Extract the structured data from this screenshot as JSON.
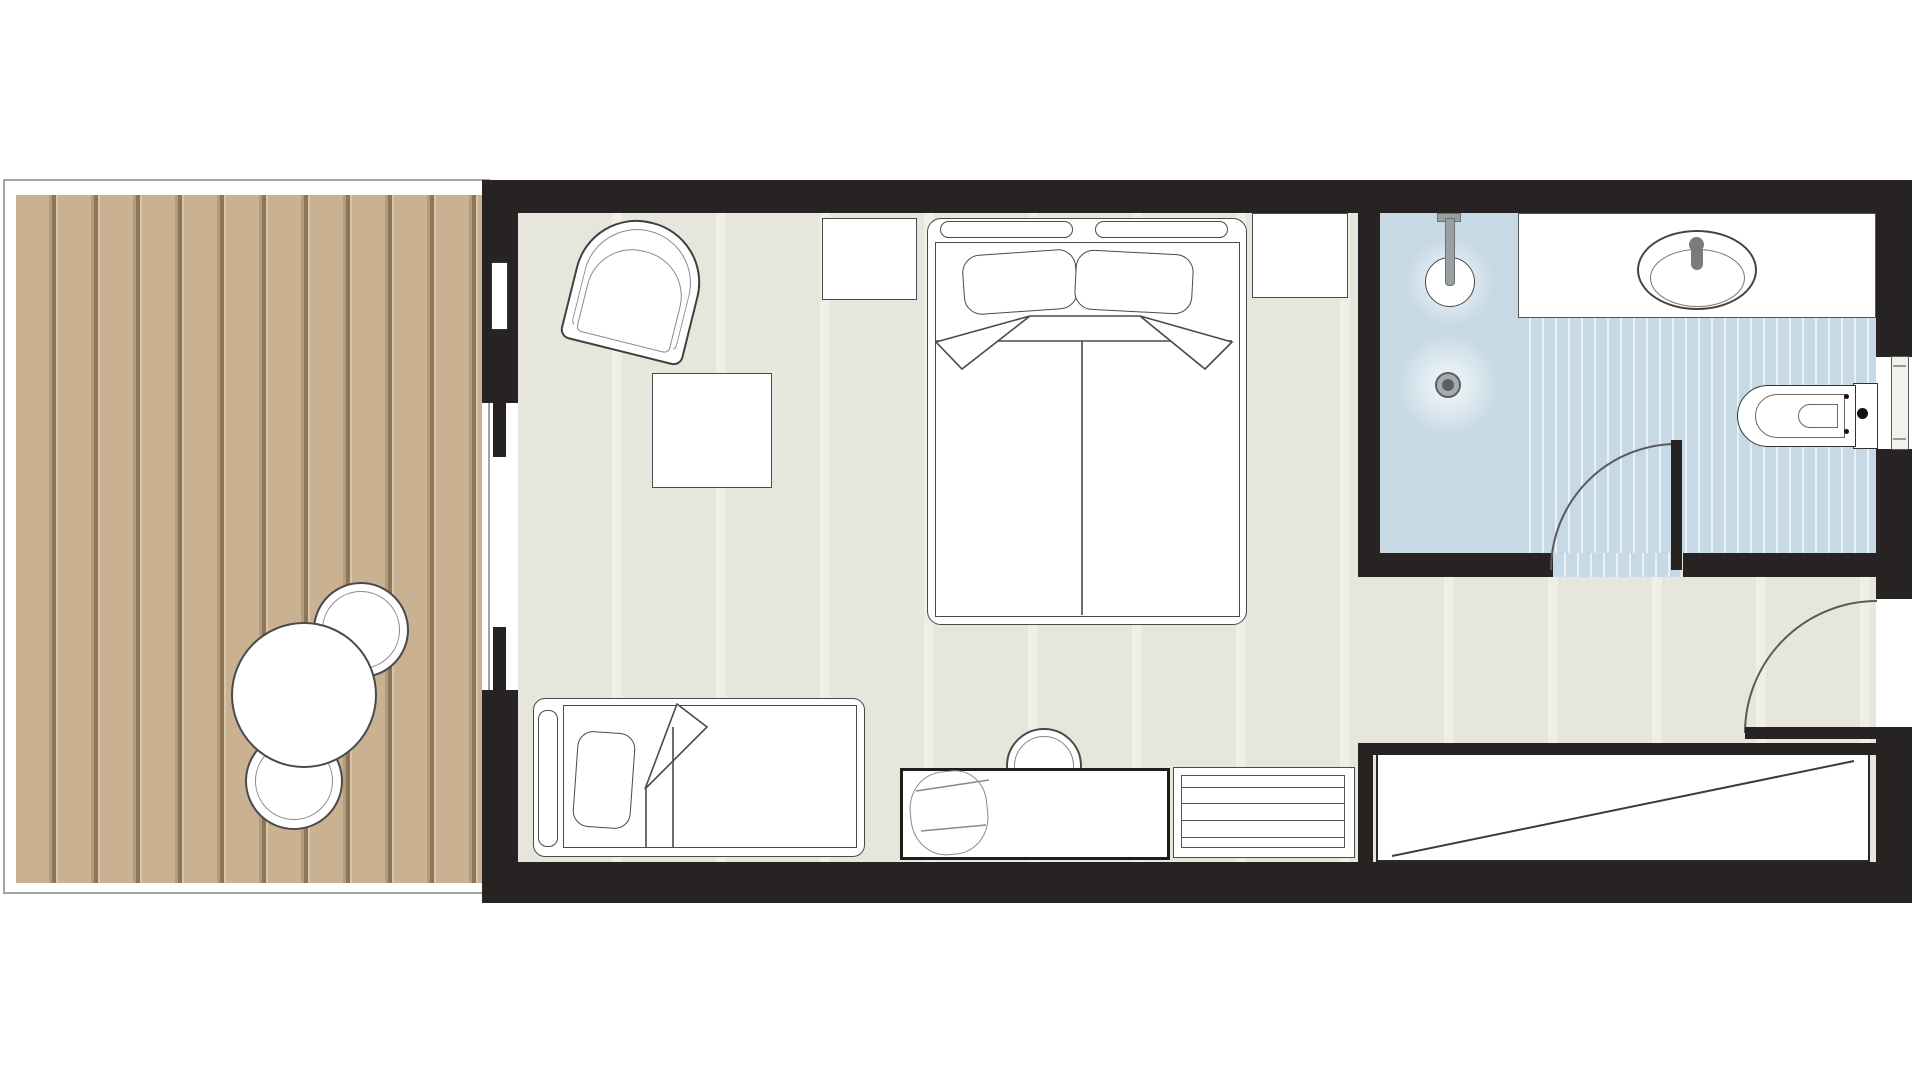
{
  "title": "Hotel guest room floor plan - top view with terrace, bedroom and bathroom",
  "colors": {
    "wall": "#272322",
    "wood-base": "#c9b192",
    "wood-mid": "#b49b7b",
    "wood-groove": "#8d7557",
    "wood-light": "#dac6a8",
    "deck-border": "#a3a3a1",
    "floor": "#e6e6dd",
    "floor-stripe": "#efefe6",
    "bath-floor": "#c6d9e5",
    "bath-stripe": "#e8f1f7",
    "line": "#4a4a4a",
    "line-soft": "#8a8a8a",
    "fixture": "#787c7e",
    "paper": "#ffffff"
  },
  "rooms": [
    {
      "name": "terrace-deck",
      "floor_finish": "timber decking planks",
      "furniture": [
        "round-outdoor-table",
        "outdoor-chair",
        "outdoor-chair"
      ]
    },
    {
      "name": "bedroom",
      "floor_finish": "pale stone tiles",
      "furniture": [
        "double-bed",
        "headboard-cushion",
        "headboard-cushion",
        "pillow",
        "pillow",
        "nightstand-left",
        "nightstand-right",
        "armchair",
        "ottoman-square",
        "daybed-single-bed",
        "bolster-pillow",
        "desk",
        "desk-chair",
        "drawer-dresser",
        "wardrobe-closet"
      ]
    },
    {
      "name": "bathroom",
      "floor_finish": "blue tile with teak shower mat",
      "furniture": [
        "walk-in-shower-head",
        "floor-drain",
        "vanity-counter",
        "oval-sink",
        "faucet",
        "toilet",
        "towel-rail"
      ]
    }
  ],
  "doors": [
    {
      "name": "sliding-door",
      "between": "terrace-deck and bedroom"
    },
    {
      "name": "bathroom-door",
      "between": "bedroom and bathroom",
      "swing": "quarter-arc"
    },
    {
      "name": "entrance-door",
      "between": "corridor and bedroom",
      "swing": "quarter-arc"
    }
  ]
}
